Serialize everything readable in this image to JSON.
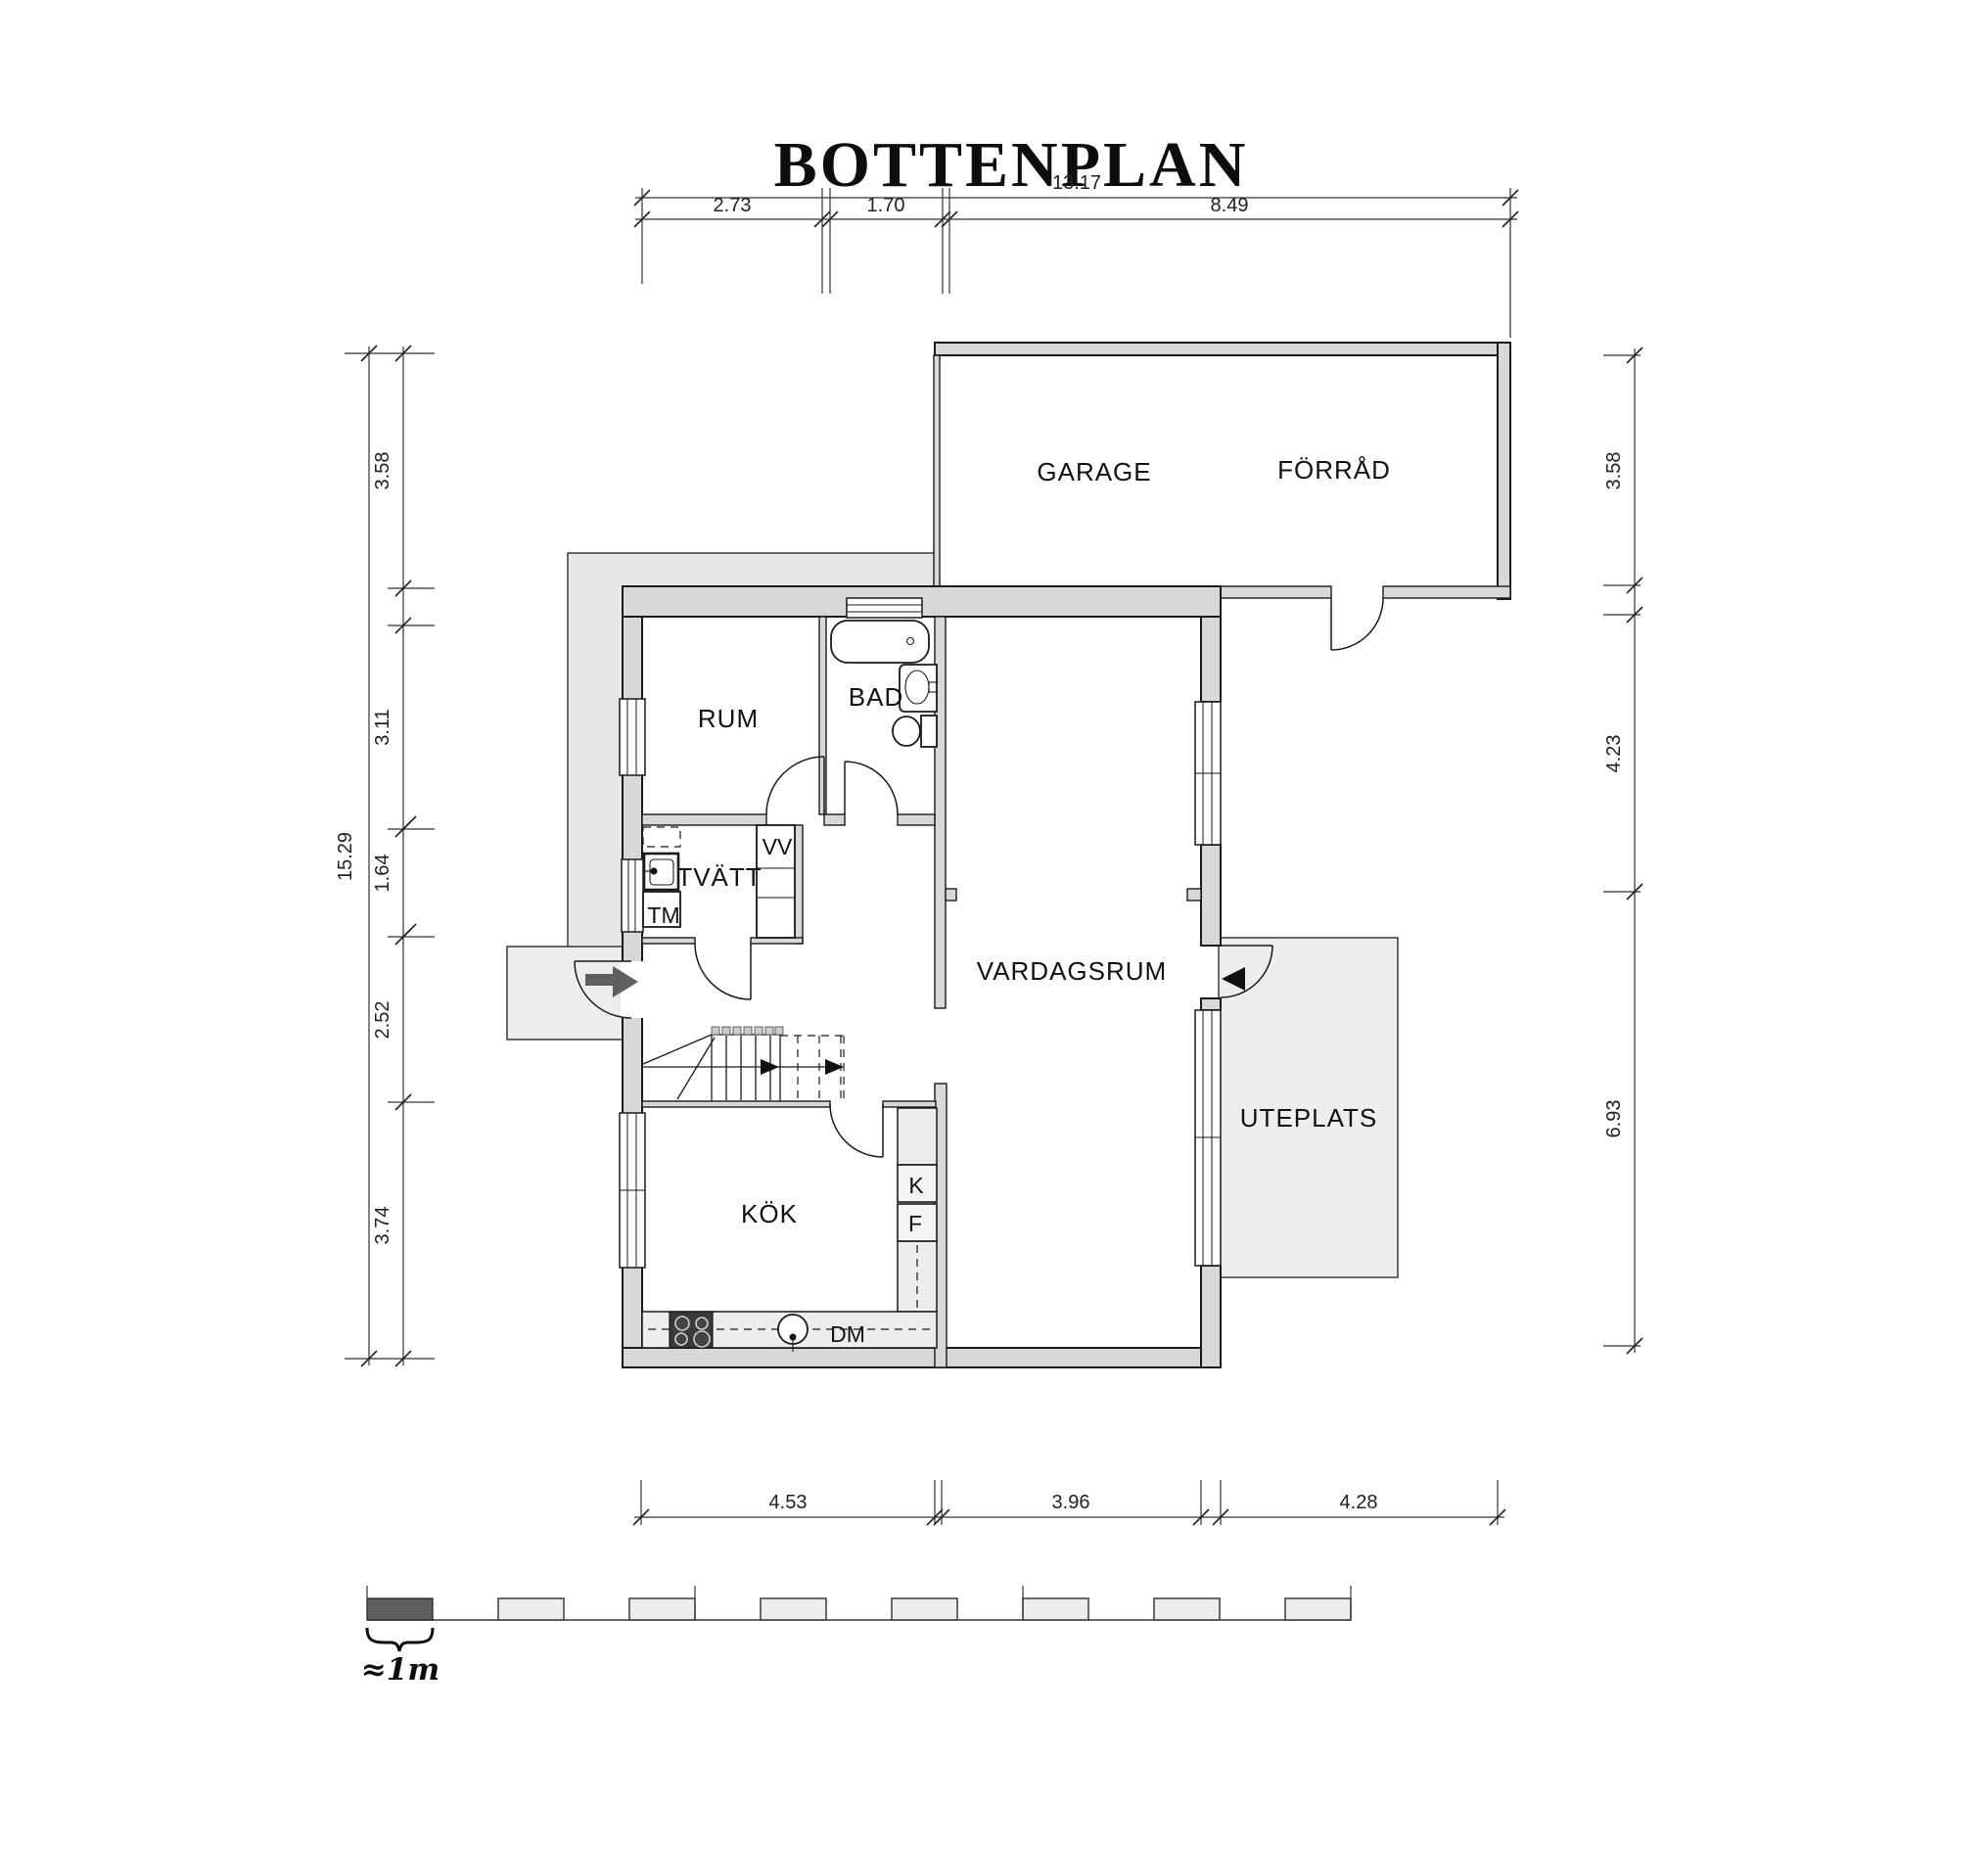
{
  "title": "BOTTENPLAN",
  "rooms": {
    "garage": "GARAGE",
    "forrad": "FÖRRÅD",
    "rum": "RUM",
    "bad": "BAD",
    "tvatt": "TVÄTT",
    "vardagsrum": "VARDAGSRUM",
    "kok": "KÖK",
    "uteplats": "UTEPLATS"
  },
  "units": {
    "vv": "VV",
    "tm": "TM",
    "k": "K",
    "f": "F",
    "dm": "DM"
  },
  "dims": {
    "top_total": "13.17",
    "top": [
      "2.73",
      "1.70",
      "8.49"
    ],
    "left_total": "15.29",
    "left": [
      "3.58",
      "3.11",
      "1.64",
      "2.52",
      "3.74"
    ],
    "right": [
      "3.58",
      "4.23",
      "6.93"
    ],
    "bottom": [
      "4.53",
      "3.96",
      "4.28"
    ]
  },
  "scale": {
    "label": "≈1m"
  },
  "colors": {
    "wall_fill": "#d8d8d8",
    "wing_fill": "#e7e7e7",
    "zone_fill": "#ededed",
    "line": "#1a1a1a",
    "arrow": "#5f5f5f"
  }
}
